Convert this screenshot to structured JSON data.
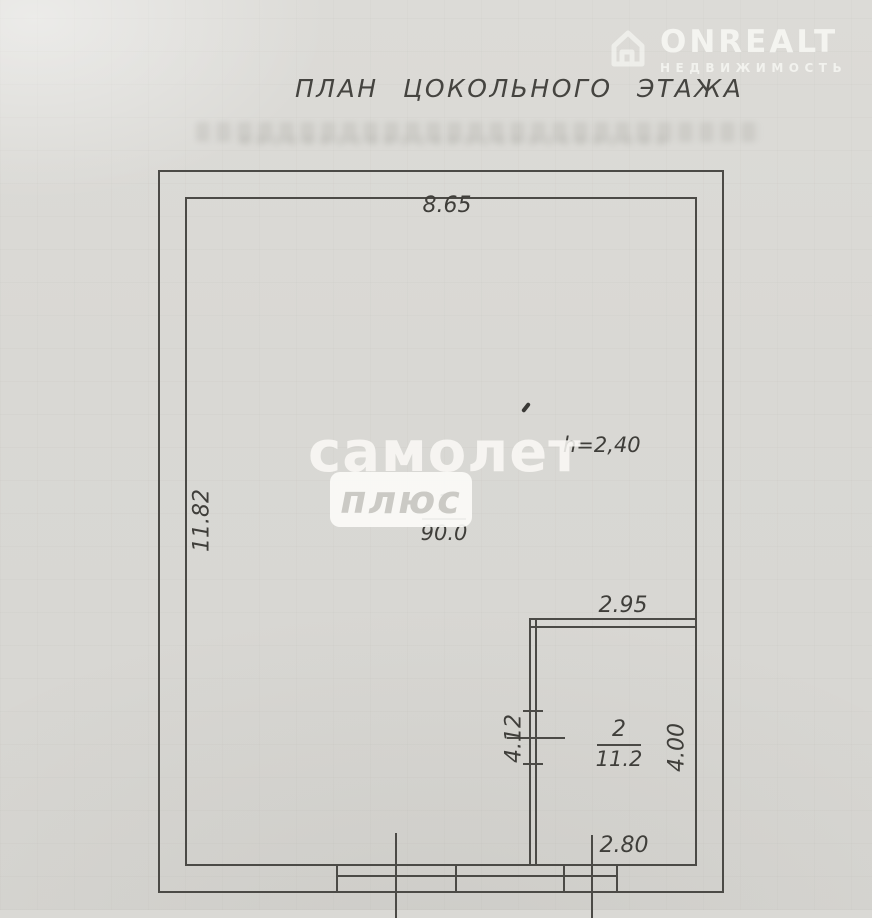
{
  "header": {
    "title": "ПЛАН ЦОКОЛЬНОГО ЭТАЖА"
  },
  "watermarks": {
    "onrealt": {
      "brand": "ONREALT",
      "subtitle": "НЕДВИЖИМОСТЬ"
    },
    "samolet": {
      "line1": "самолет",
      "line2": "плюс"
    }
  },
  "plan": {
    "height_note": "h=2,40",
    "dimensions": {
      "top_width": "8.65",
      "left_height": "11.82",
      "room2_width_top": "2.95",
      "room2_height_left": "4.12",
      "room2_height_right": "4.00",
      "room2_width_bottom": "2.80"
    },
    "rooms": [
      {
        "number": "1",
        "area": "90.0"
      },
      {
        "number": "2",
        "area": "11.2"
      }
    ]
  },
  "colors": {
    "paper": "#dad9d5",
    "ink": "#4b4a46",
    "watermark_white": "#f8f8f4"
  }
}
